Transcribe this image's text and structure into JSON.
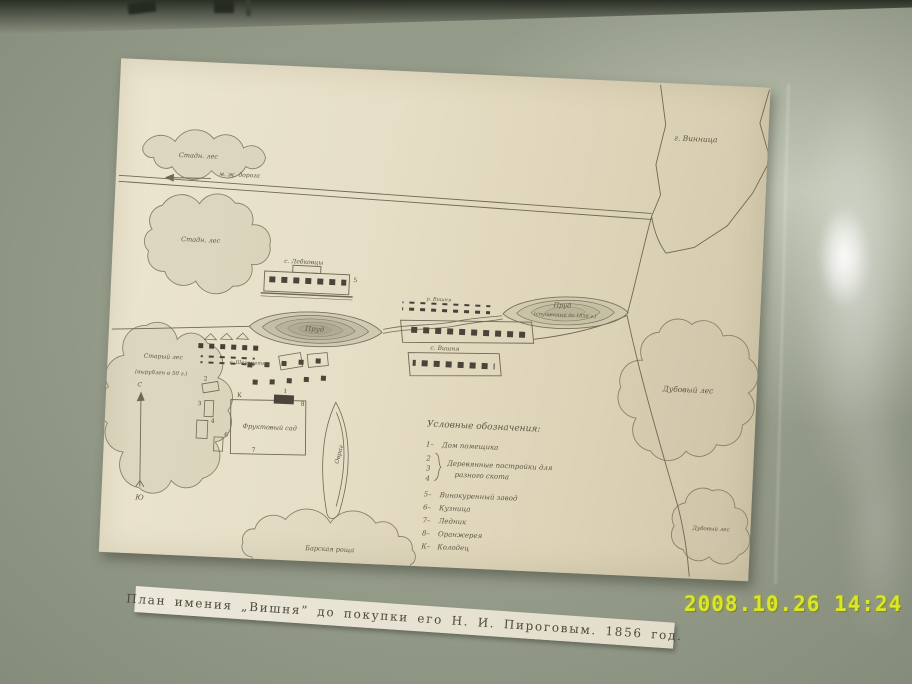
{
  "photo": {
    "timestamp": "2008.10.26 14:24",
    "timestamp_color": "#dde526",
    "wall_color": "#949a88",
    "paper_color": "#e6dec6"
  },
  "caption": {
    "text": "План имения „Вишня” до покупки его Н. И. Пироговым. 1856 год."
  },
  "map": {
    "labels": {
      "city": "г. Винница",
      "road_top": "м. ж. дорога",
      "forest_top_left": "Стадн. лес",
      "forest_left": "Стадн. лес",
      "forest_old_1": "Старый лес",
      "forest_old_2": "(вырублен в 50 г.)",
      "farmstead": "с. Лебковцы",
      "pond_left": "Пруд",
      "pond_right_1": "Пруд",
      "pond_right_2": "(спущенный до 1856 г.)",
      "river": "р. Вишня",
      "village": "с. Вишня",
      "hamlet": "с. Шереметка",
      "orchard": "Фруктовый сад",
      "ravine": "Овраг",
      "oak_forest": "Дубовый лес",
      "oak_forest_small": "Дубовый лес",
      "grove": "Барская роща",
      "compass_north": "С",
      "compass_south": "Ю"
    },
    "markers": [
      "1",
      "2",
      "3",
      "4",
      "5",
      "6",
      "7",
      "8",
      "К"
    ],
    "legend": {
      "title": "Условные обозначения:",
      "items": [
        {
          "num": "1–",
          "label": "Дом помещика"
        },
        {
          "num": "2",
          "label": ""
        },
        {
          "num": "3",
          "label": "Деревянные постройки для"
        },
        {
          "num": "4",
          "label": "разного скота"
        },
        {
          "num": "5–",
          "label": "Винокуренный завод"
        },
        {
          "num": "6–",
          "label": "Кузница"
        },
        {
          "num": "7–",
          "label": "Ледник"
        },
        {
          "num": "8–",
          "label": "Оранжерея"
        },
        {
          "num": "К–",
          "label": "Колодец"
        }
      ]
    }
  }
}
